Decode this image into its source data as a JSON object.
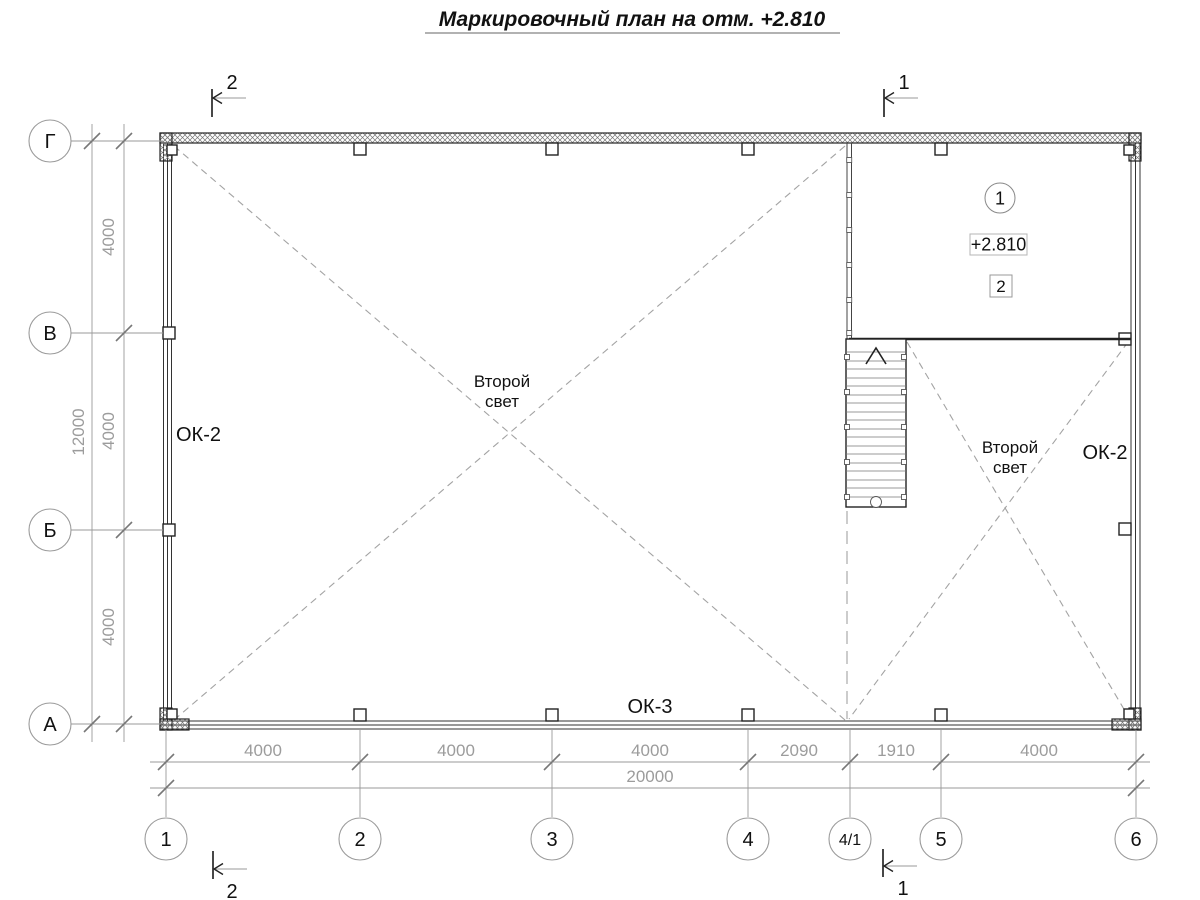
{
  "title": {
    "text": "Маркировочный план на отм. +2.810"
  },
  "axes": {
    "rows": [
      "Г",
      "В",
      "Б",
      "А"
    ],
    "cols": [
      "1",
      "2",
      "3",
      "4",
      "4/1",
      "5",
      "6"
    ]
  },
  "dims": {
    "vertical": {
      "segments": [
        "4000",
        "4000",
        "4000"
      ],
      "total": "12000"
    },
    "horizontal": {
      "segments": [
        "4000",
        "4000",
        "4000",
        "2090",
        "1910",
        "4000"
      ],
      "total": "20000"
    }
  },
  "sections": {
    "one": "1",
    "two": "2"
  },
  "plan": {
    "window_left": "ОК-2",
    "window_right": "ОК-2",
    "window_bottom": "ОК-3",
    "void_left": {
      "line1": "Второй",
      "line2": "свет"
    },
    "void_right": {
      "line1": "Второй",
      "line2": "свет"
    },
    "room": {
      "number": "1",
      "elevation": "+2.810",
      "detail": "2"
    }
  },
  "colors": {
    "line": "#222222",
    "dimension": "#999999",
    "dimension_text": "#9c9c9c",
    "dashed_void": "#a3a3a3"
  }
}
